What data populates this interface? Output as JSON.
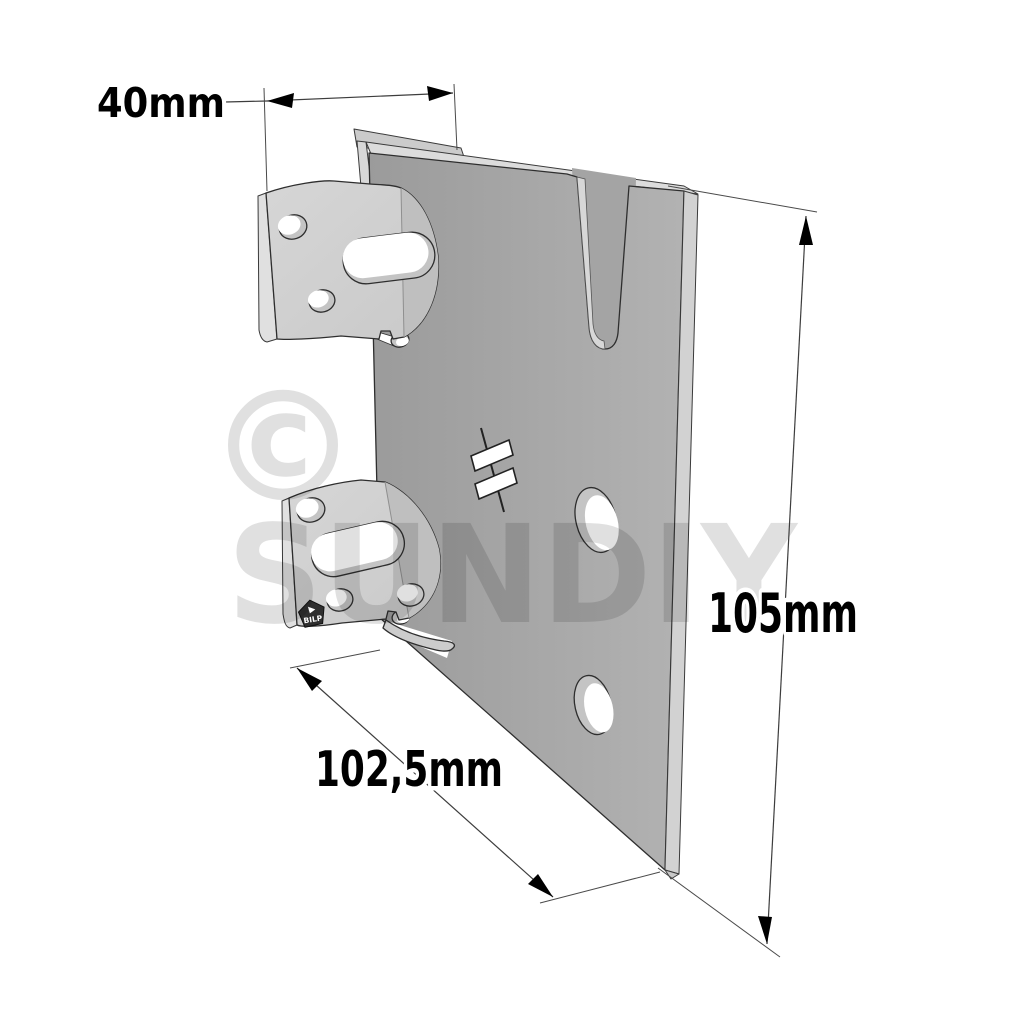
{
  "scene": {
    "description": "3D CAD-style render of a folded sheet-metal bracket plate with two bent mounting tabs, a U-slot at the top and two oval holes"
  },
  "dimensions": {
    "top_width": "40mm",
    "right_height": "105mm",
    "bottom_width": "102,5mm"
  },
  "watermark": {
    "copyright_symbol": "©",
    "brand": "SUNDIY"
  },
  "badge": {
    "label": "BILP"
  },
  "colors": {
    "background": "#ffffff",
    "plate_face": "#a8a8a8",
    "tab_face": "#d1d1d1",
    "bend_face": "#bfbfbf",
    "edge_highlight": "#dcdcdc",
    "hole_wall": "#c4c4c4",
    "outline": "#2e2e2e",
    "dimension_text": "#000000",
    "badge_bg": "#2f2f2f",
    "watermark": "rgba(0,0,0,0.12)"
  }
}
